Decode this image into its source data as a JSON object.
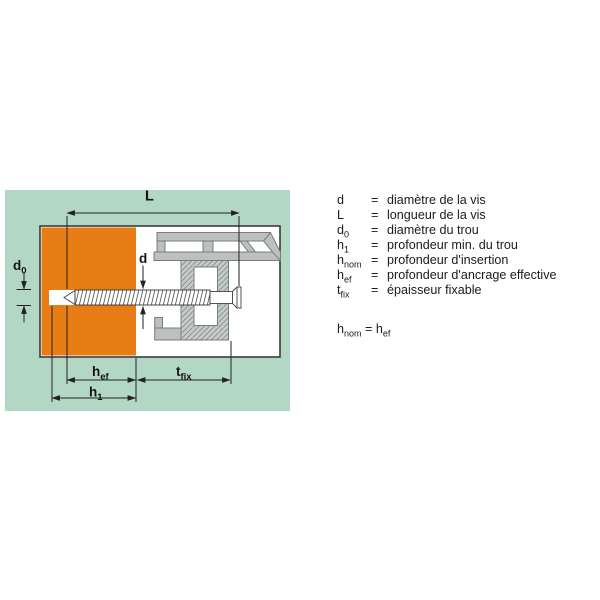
{
  "figure": {
    "dimension_labels": {
      "L": {
        "main": "L",
        "sub": ""
      },
      "d": {
        "main": "d",
        "sub": ""
      },
      "d0": {
        "main": "d",
        "sub": "0"
      },
      "hef": {
        "main": "h",
        "sub": "ef"
      },
      "h1": {
        "main": "h",
        "sub": "1"
      },
      "tfix": {
        "main": "t",
        "sub": "fix"
      }
    },
    "colors": {
      "panel_background": "#b2d7c4",
      "base_material_orange": "#e87d15",
      "profile_gray": "#bcc0c0",
      "line_dark": "#222222"
    }
  },
  "legend": {
    "rows": [
      {
        "sym": "d",
        "sub": "",
        "eq": "=",
        "desc": "diamètre de la vis"
      },
      {
        "sym": "L",
        "sub": "",
        "eq": "=",
        "desc": "longueur de la vis"
      },
      {
        "sym": "d",
        "sub": "0",
        "eq": "=",
        "desc": "diamètre du trou"
      },
      {
        "sym": "h",
        "sub": "1",
        "eq": "=",
        "desc": "profondeur min. du trou"
      },
      {
        "sym": "h",
        "sub": "nom",
        "eq": "=",
        "desc": "profondeur d'insertion"
      },
      {
        "sym": "h",
        "sub": "ef",
        "eq": "=",
        "desc": "profondeur d'ancrage effective"
      },
      {
        "sym": "t",
        "sub": "fix",
        "eq": "=",
        "desc": "épaisseur fixable"
      }
    ],
    "note": {
      "lhs": "h",
      "lhs_sub": "nom",
      "eq": "=",
      "rhs": "h",
      "rhs_sub": "ef"
    }
  }
}
